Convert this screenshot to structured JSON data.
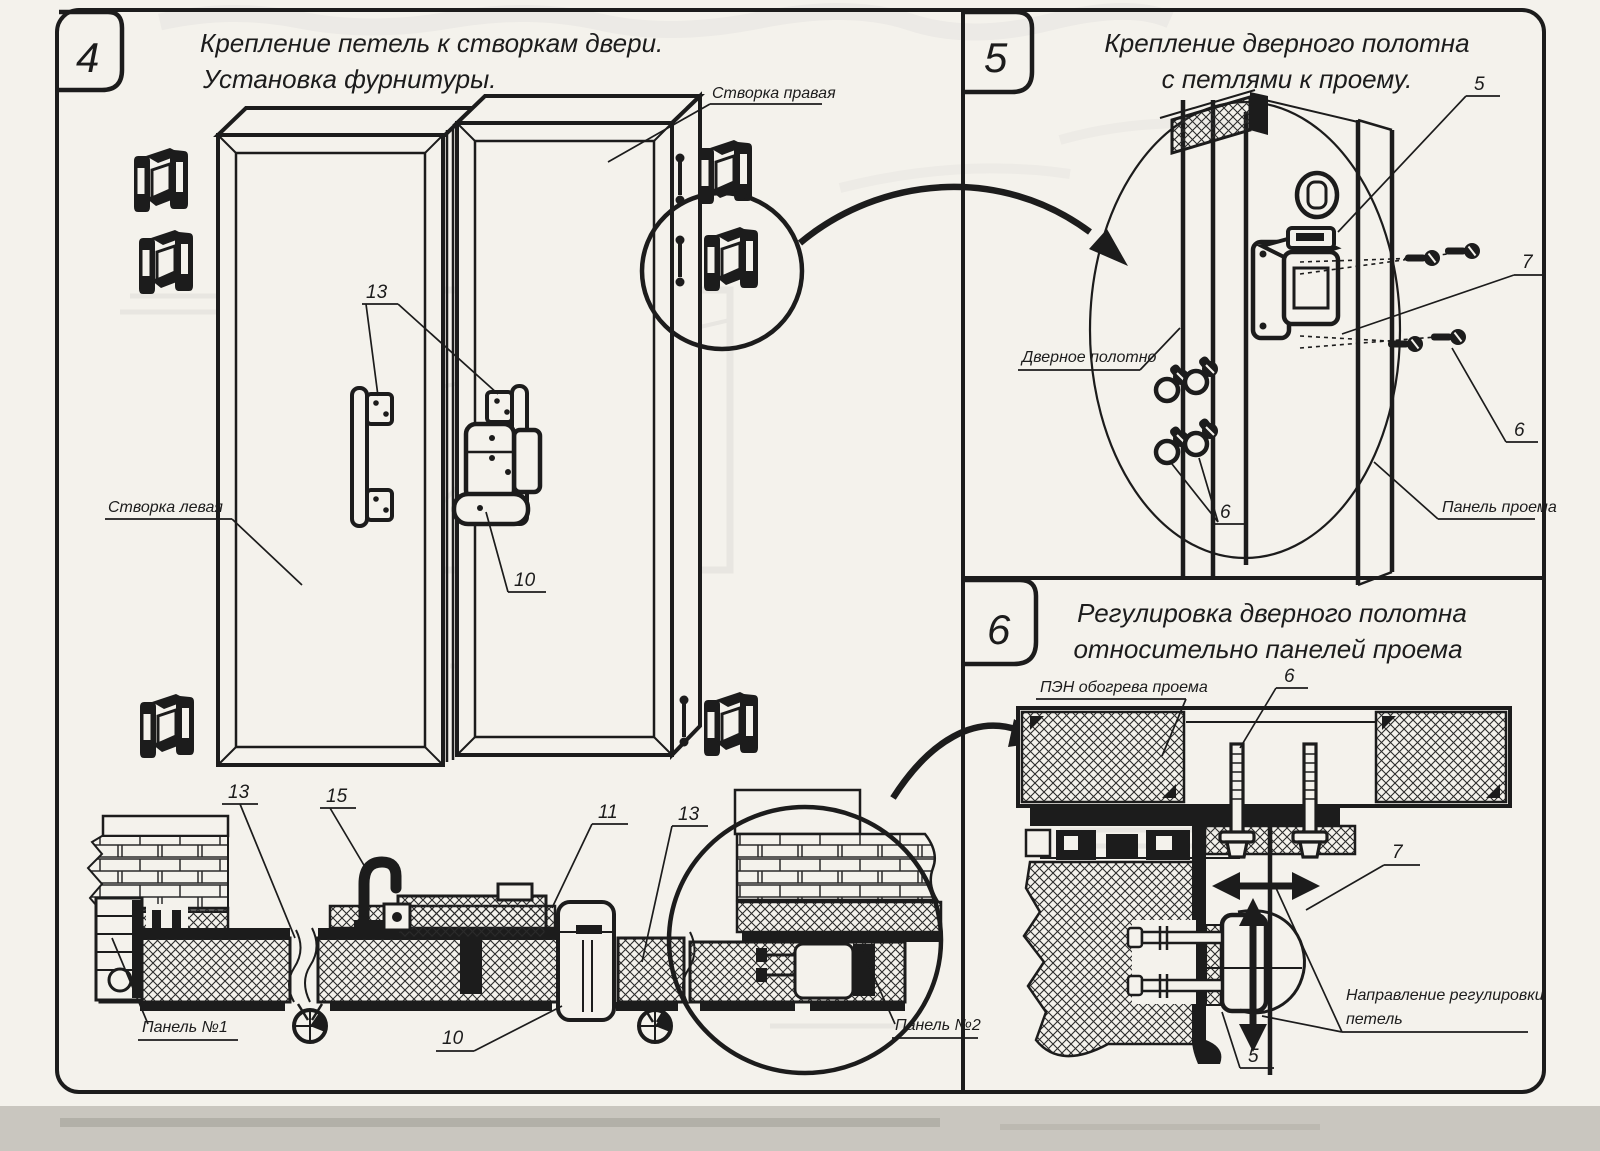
{
  "document": {
    "ink_color": "#1c1c1c",
    "paper_color": "#f4f2ec",
    "background_color": "#c9c6bf"
  },
  "steps": {
    "step4": {
      "number": "4",
      "title_line1": "Крепление петель к створкам двери.",
      "title_line2": "Установка фурнитуры.",
      "labels": {
        "right_leaf": "Створка правая",
        "left_leaf": "Створка левая",
        "panel_1": "Панель №1",
        "panel_2": "Панель №2"
      },
      "callouts": {
        "handles_13": "13",
        "latch_10": "10",
        "section_13_left": "13",
        "section_15": "15",
        "section_11": "11",
        "section_13_right": "13",
        "section_10": "10"
      }
    },
    "step5": {
      "number": "5",
      "title_line1": "Крепление дверного полотна",
      "title_line2": "с петлями к проему.",
      "labels": {
        "door_leaf": "Дверное полотно",
        "opening_panel": "Панель проема"
      },
      "callouts": {
        "hinge_5": "5",
        "adjuster_7": "7",
        "screws_6_right": "6",
        "screws_6_left": "6"
      }
    },
    "step6": {
      "number": "6",
      "title_line1": "Регулировка дверного полотна",
      "title_line2": "относительно панелей проема",
      "labels": {
        "heater": "ПЭН обогрева проема",
        "direction_line1": "Направление регулировки",
        "direction_line2": "петель"
      },
      "callouts": {
        "bolts_6": "6",
        "hinge_7": "7",
        "hinge_5": "5"
      }
    }
  }
}
